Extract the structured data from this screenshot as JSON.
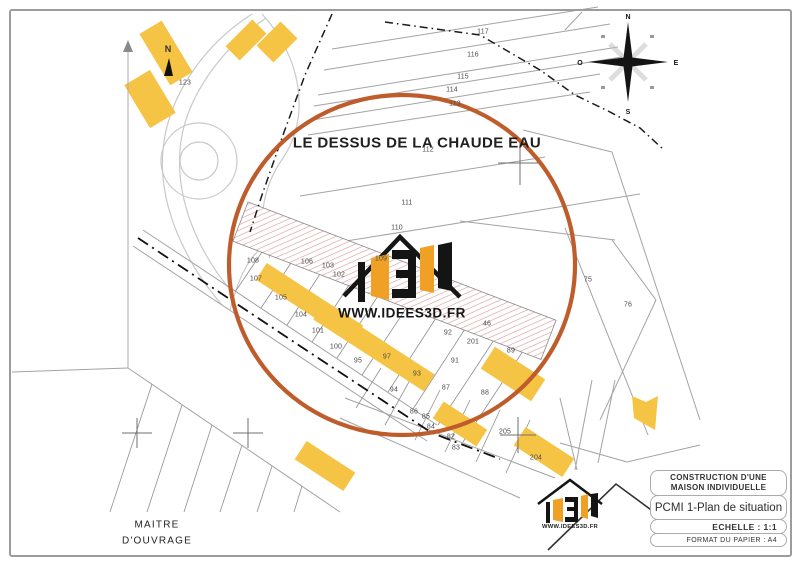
{
  "map": {
    "area_label": "LE DESSUS DE LA CHAUDE EAU",
    "north_label": "N",
    "compass": {
      "n": "N",
      "s": "S",
      "e": "E",
      "o": "O"
    },
    "parcels": [
      {
        "n": "117",
        "x": 483,
        "y": 32
      },
      {
        "n": "116",
        "x": 473,
        "y": 55
      },
      {
        "n": "115",
        "x": 463,
        "y": 77
      },
      {
        "n": "114",
        "x": 452,
        "y": 90
      },
      {
        "n": "113",
        "x": 455,
        "y": 104
      },
      {
        "n": "112",
        "x": 428,
        "y": 150
      },
      {
        "n": "111",
        "x": 407,
        "y": 203
      },
      {
        "n": "110",
        "x": 397,
        "y": 228
      },
      {
        "n": "123",
        "x": 185,
        "y": 83
      },
      {
        "n": "108",
        "x": 253,
        "y": 261
      },
      {
        "n": "106",
        "x": 307,
        "y": 262
      },
      {
        "n": "103",
        "x": 328,
        "y": 266
      },
      {
        "n": "109",
        "x": 381,
        "y": 259
      },
      {
        "n": "107",
        "x": 256,
        "y": 279
      },
      {
        "n": "102",
        "x": 339,
        "y": 275
      },
      {
        "n": "105",
        "x": 281,
        "y": 298
      },
      {
        "n": "104",
        "x": 301,
        "y": 315
      },
      {
        "n": "101",
        "x": 318,
        "y": 331
      },
      {
        "n": "100",
        "x": 336,
        "y": 347
      },
      {
        "n": "95",
        "x": 358,
        "y": 361
      },
      {
        "n": "97",
        "x": 387,
        "y": 357
      },
      {
        "n": "92",
        "x": 448,
        "y": 333
      },
      {
        "n": "46",
        "x": 487,
        "y": 324
      },
      {
        "n": "201",
        "x": 473,
        "y": 342
      },
      {
        "n": "91",
        "x": 455,
        "y": 361
      },
      {
        "n": "89",
        "x": 511,
        "y": 351
      },
      {
        "n": "93",
        "x": 417,
        "y": 374
      },
      {
        "n": "94",
        "x": 394,
        "y": 390
      },
      {
        "n": "87",
        "x": 446,
        "y": 388
      },
      {
        "n": "88",
        "x": 485,
        "y": 393
      },
      {
        "n": "86",
        "x": 414,
        "y": 412
      },
      {
        "n": "85",
        "x": 426,
        "y": 417
      },
      {
        "n": "84",
        "x": 431,
        "y": 427
      },
      {
        "n": "82",
        "x": 451,
        "y": 437
      },
      {
        "n": "83",
        "x": 456,
        "y": 448
      },
      {
        "n": "205",
        "x": 505,
        "y": 432
      },
      {
        "n": "204",
        "x": 536,
        "y": 458
      },
      {
        "n": "75",
        "x": 588,
        "y": 280
      },
      {
        "n": "76",
        "x": 628,
        "y": 305
      }
    ]
  },
  "watermark": {
    "url": "WWW.IDEES3D.FR"
  },
  "footer": {
    "maitre_line1": "MAITRE",
    "maitre_line2": "D'OUVRAGE",
    "logo_url": "WWW.IDEES3D.FR",
    "titleblock": {
      "project_line1": "CONSTRUCTION  D'UNE",
      "project_line2": "MAISON INDIVIDUELLE",
      "doc_title": "PCMI 1-Plan de situation",
      "scale": "ECHELLE : 1:1",
      "format": "FORMAT DU PAPIER : A4"
    }
  },
  "colors": {
    "circle": "#bf5c2b",
    "building": "#f6c445",
    "hatch": "#dc9898",
    "mapline": "#a3a3a3"
  }
}
